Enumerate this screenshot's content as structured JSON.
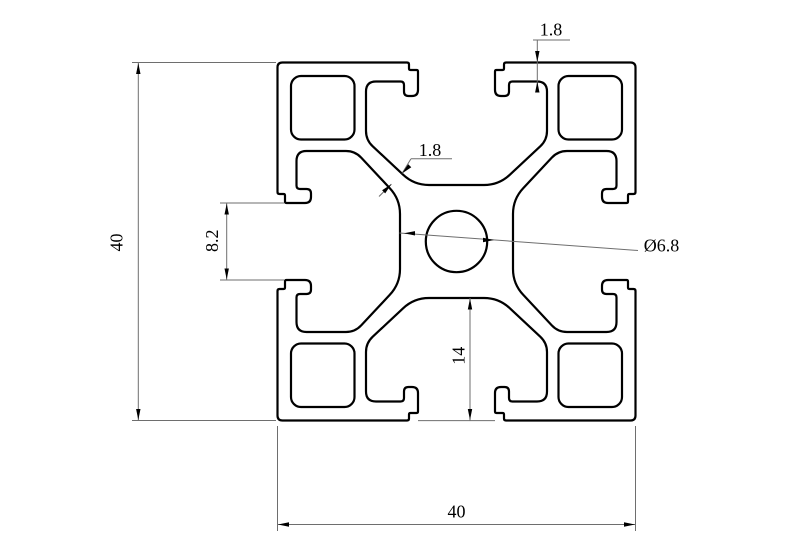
{
  "drawing": {
    "background": "#ffffff",
    "outline_color": "#000000",
    "dimension_line_color": "#6e6e6e",
    "arrow_color": "#000000",
    "dimensions": {
      "overall_height": {
        "label": "40"
      },
      "overall_width": {
        "label": "40"
      },
      "slot_opening": {
        "label": "8.2"
      },
      "face_wall_thickness": {
        "label": "1.8"
      },
      "web_thickness": {
        "label": "1.8"
      },
      "center_hole_diameter": {
        "label": "Ø6.8"
      },
      "slot_depth": {
        "label": "14"
      }
    }
  }
}
